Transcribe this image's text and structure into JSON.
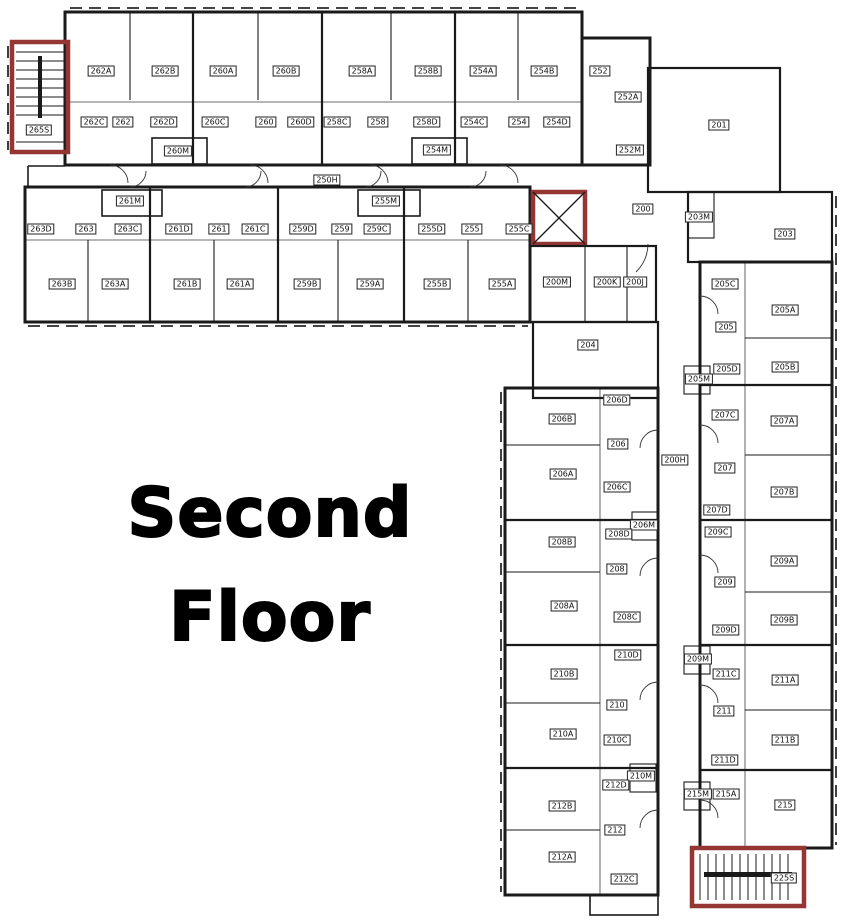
{
  "title": {
    "line1": "Second",
    "line2": "Floor"
  },
  "colors": {
    "wall": "#1a1a1a",
    "stair_accent": "#943634",
    "background": "#ffffff",
    "label_text": "#111111"
  },
  "stairwells": [
    {
      "label": "265S"
    },
    {
      "label": "225S"
    }
  ],
  "corridors": [
    {
      "label": "250H"
    },
    {
      "label": "200H"
    },
    {
      "label": "200"
    }
  ],
  "labels": [
    {
      "text": "262A",
      "x": 101,
      "y": 71
    },
    {
      "text": "262B",
      "x": 165,
      "y": 71
    },
    {
      "text": "260A",
      "x": 223,
      "y": 71
    },
    {
      "text": "260B",
      "x": 286,
      "y": 71
    },
    {
      "text": "258A",
      "x": 362,
      "y": 71
    },
    {
      "text": "258B",
      "x": 428,
      "y": 71
    },
    {
      "text": "254A",
      "x": 483,
      "y": 71
    },
    {
      "text": "254B",
      "x": 544,
      "y": 71
    },
    {
      "text": "252",
      "x": 600,
      "y": 71
    },
    {
      "text": "262C",
      "x": 94,
      "y": 122
    },
    {
      "text": "262",
      "x": 123,
      "y": 122
    },
    {
      "text": "262D",
      "x": 164,
      "y": 122
    },
    {
      "text": "260C",
      "x": 215,
      "y": 122
    },
    {
      "text": "260",
      "x": 266,
      "y": 122
    },
    {
      "text": "260D",
      "x": 301,
      "y": 122
    },
    {
      "text": "258C",
      "x": 337,
      "y": 122
    },
    {
      "text": "258",
      "x": 378,
      "y": 122
    },
    {
      "text": "258D",
      "x": 427,
      "y": 122
    },
    {
      "text": "254C",
      "x": 474,
      "y": 122
    },
    {
      "text": "254",
      "x": 519,
      "y": 122
    },
    {
      "text": "254D",
      "x": 557,
      "y": 122
    },
    {
      "text": "260M",
      "x": 178,
      "y": 151
    },
    {
      "text": "254M",
      "x": 437,
      "y": 150
    },
    {
      "text": "252A",
      "x": 628,
      "y": 97
    },
    {
      "text": "252M",
      "x": 630,
      "y": 150
    },
    {
      "text": "265S",
      "x": 39,
      "y": 130
    },
    {
      "text": "250H",
      "x": 327,
      "y": 180
    },
    {
      "text": "201",
      "x": 719,
      "y": 125
    },
    {
      "text": "200",
      "x": 643,
      "y": 209
    },
    {
      "text": "261M",
      "x": 130,
      "y": 201
    },
    {
      "text": "255M",
      "x": 386,
      "y": 201
    },
    {
      "text": "263D",
      "x": 41,
      "y": 229
    },
    {
      "text": "263",
      "x": 86,
      "y": 229
    },
    {
      "text": "263C",
      "x": 128,
      "y": 229
    },
    {
      "text": "261D",
      "x": 179,
      "y": 229
    },
    {
      "text": "261",
      "x": 219,
      "y": 229
    },
    {
      "text": "261C",
      "x": 255,
      "y": 229
    },
    {
      "text": "259D",
      "x": 303,
      "y": 229
    },
    {
      "text": "259",
      "x": 342,
      "y": 229
    },
    {
      "text": "259C",
      "x": 377,
      "y": 229
    },
    {
      "text": "255D",
      "x": 432,
      "y": 229
    },
    {
      "text": "255",
      "x": 472,
      "y": 229
    },
    {
      "text": "255C",
      "x": 519,
      "y": 229
    },
    {
      "text": "263B",
      "x": 62,
      "y": 284
    },
    {
      "text": "263A",
      "x": 115,
      "y": 284
    },
    {
      "text": "261B",
      "x": 187,
      "y": 284
    },
    {
      "text": "261A",
      "x": 240,
      "y": 284
    },
    {
      "text": "259B",
      "x": 307,
      "y": 284
    },
    {
      "text": "259A",
      "x": 370,
      "y": 284
    },
    {
      "text": "255B",
      "x": 437,
      "y": 284
    },
    {
      "text": "255A",
      "x": 502,
      "y": 284
    },
    {
      "text": "200M",
      "x": 557,
      "y": 282
    },
    {
      "text": "200K",
      "x": 607,
      "y": 282
    },
    {
      "text": "200J",
      "x": 635,
      "y": 282
    },
    {
      "text": "204",
      "x": 588,
      "y": 345
    },
    {
      "text": "203M",
      "x": 699,
      "y": 217
    },
    {
      "text": "203",
      "x": 785,
      "y": 234
    },
    {
      "text": "205C",
      "x": 725,
      "y": 284
    },
    {
      "text": "205A",
      "x": 785,
      "y": 310
    },
    {
      "text": "205",
      "x": 726,
      "y": 327
    },
    {
      "text": "205B",
      "x": 785,
      "y": 367
    },
    {
      "text": "205D",
      "x": 727,
      "y": 369
    },
    {
      "text": "205M",
      "x": 699,
      "y": 379
    },
    {
      "text": "207C",
      "x": 725,
      "y": 415
    },
    {
      "text": "207A",
      "x": 784,
      "y": 421
    },
    {
      "text": "207",
      "x": 725,
      "y": 468
    },
    {
      "text": "207B",
      "x": 784,
      "y": 492
    },
    {
      "text": "207D",
      "x": 717,
      "y": 510
    },
    {
      "text": "209C",
      "x": 718,
      "y": 532
    },
    {
      "text": "209A",
      "x": 784,
      "y": 561
    },
    {
      "text": "209",
      "x": 725,
      "y": 582
    },
    {
      "text": "209B",
      "x": 784,
      "y": 620
    },
    {
      "text": "209D",
      "x": 726,
      "y": 630
    },
    {
      "text": "209M",
      "x": 698,
      "y": 659
    },
    {
      "text": "211C",
      "x": 726,
      "y": 674
    },
    {
      "text": "211A",
      "x": 785,
      "y": 680
    },
    {
      "text": "211",
      "x": 724,
      "y": 711
    },
    {
      "text": "211B",
      "x": 785,
      "y": 740
    },
    {
      "text": "211D",
      "x": 725,
      "y": 760
    },
    {
      "text": "215M",
      "x": 698,
      "y": 794
    },
    {
      "text": "215A",
      "x": 726,
      "y": 794
    },
    {
      "text": "215",
      "x": 785,
      "y": 805
    },
    {
      "text": "225S",
      "x": 784,
      "y": 878
    },
    {
      "text": "200H",
      "x": 675,
      "y": 460
    },
    {
      "text": "206D",
      "x": 617,
      "y": 400
    },
    {
      "text": "206B",
      "x": 562,
      "y": 419
    },
    {
      "text": "206",
      "x": 618,
      "y": 444
    },
    {
      "text": "206A",
      "x": 563,
      "y": 474
    },
    {
      "text": "206C",
      "x": 617,
      "y": 487
    },
    {
      "text": "206M",
      "x": 644,
      "y": 525
    },
    {
      "text": "208D",
      "x": 619,
      "y": 534
    },
    {
      "text": "208B",
      "x": 562,
      "y": 542
    },
    {
      "text": "208",
      "x": 617,
      "y": 569
    },
    {
      "text": "208A",
      "x": 564,
      "y": 606
    },
    {
      "text": "208C",
      "x": 627,
      "y": 617
    },
    {
      "text": "210D",
      "x": 628,
      "y": 655
    },
    {
      "text": "210B",
      "x": 564,
      "y": 674
    },
    {
      "text": "210",
      "x": 617,
      "y": 705
    },
    {
      "text": "210A",
      "x": 563,
      "y": 734
    },
    {
      "text": "210C",
      "x": 617,
      "y": 740
    },
    {
      "text": "210M",
      "x": 641,
      "y": 776
    },
    {
      "text": "212D",
      "x": 616,
      "y": 785
    },
    {
      "text": "212B",
      "x": 562,
      "y": 806
    },
    {
      "text": "212",
      "x": 615,
      "y": 830
    },
    {
      "text": "212A",
      "x": 562,
      "y": 857
    },
    {
      "text": "212C",
      "x": 624,
      "y": 879
    }
  ]
}
